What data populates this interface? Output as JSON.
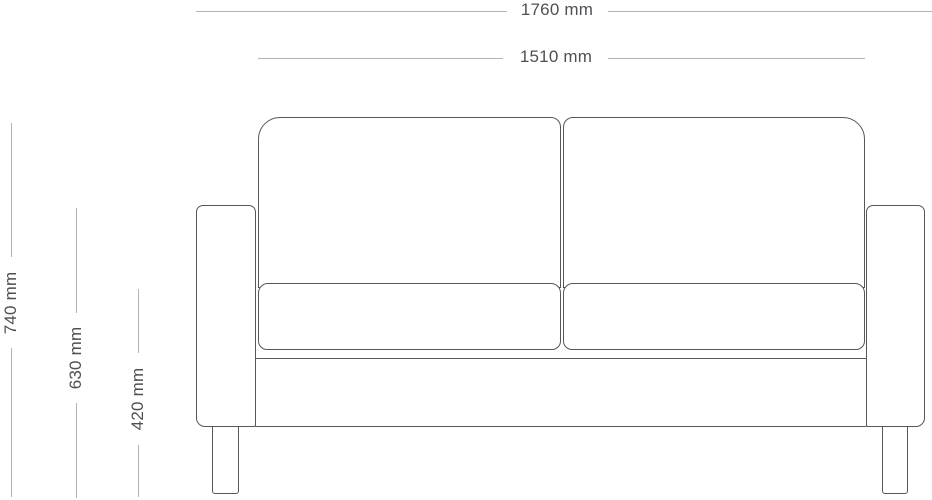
{
  "diagram": {
    "type": "furniture-dimension-drawing",
    "subject": "two-seat sofa, front elevation",
    "unit": "mm",
    "colors": {
      "background": "#ffffff",
      "outline": "#56575b",
      "dimension_line": "#b3b3b3",
      "dimension_text": "#4f5054"
    },
    "dimensions": {
      "overall_width": {
        "value": 1760,
        "label": "1760 mm"
      },
      "inner_width": {
        "value": 1510,
        "label": "1510 mm"
      },
      "overall_height": {
        "value": 740,
        "label": "740 mm"
      },
      "armrest_height": {
        "value": 630,
        "label": "630 mm"
      },
      "seat_height": {
        "value": 420,
        "label": "420 mm"
      }
    }
  }
}
